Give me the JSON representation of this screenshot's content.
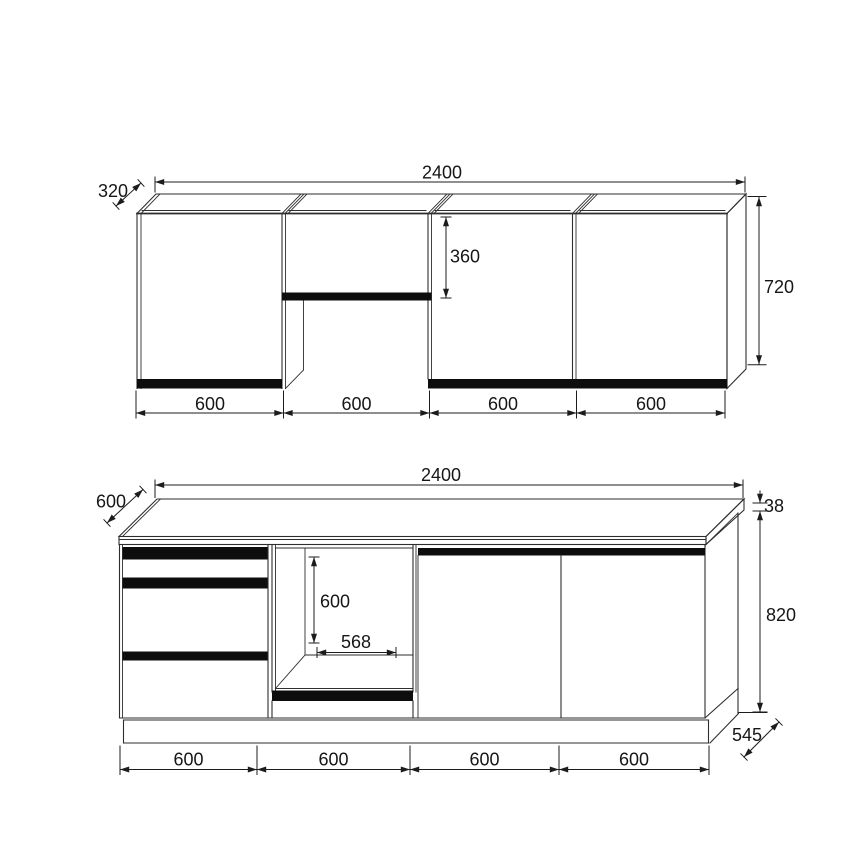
{
  "drawing_type": "kitchen cabinet elevation",
  "upper": {
    "name": "wall-cabinets-elevation",
    "total_width": "2400",
    "depth": "320",
    "height": "720",
    "flap_height": "360",
    "sections": [
      "600",
      "600",
      "600",
      "600"
    ]
  },
  "base": {
    "name": "base-cabinets-elevation",
    "total_width": "2400",
    "worktop_depth": "600",
    "worktop_thickness": "38",
    "body_height": "820",
    "body_depth": "545",
    "niche_height": "600",
    "niche_width": "568",
    "sections": [
      "600",
      "600",
      "600",
      "600"
    ]
  },
  "colors": {
    "line": "#2e2e2e",
    "dim": "#1c1c1c",
    "panel_strip": "#0d0d0d",
    "background": "#ffffff"
  }
}
